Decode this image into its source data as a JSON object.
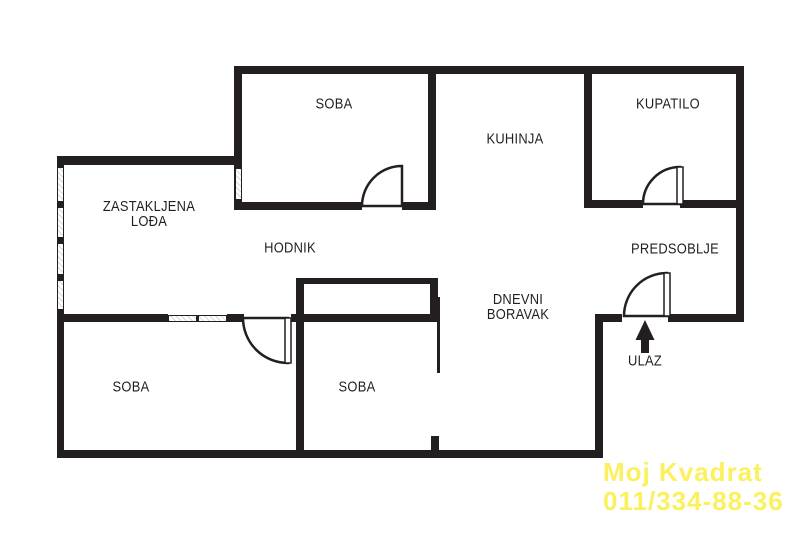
{
  "plan_title": "apartment-floor-plan",
  "colors": {
    "wall": "#231f20",
    "background": "#ffffff",
    "label_text": "#231f20",
    "watermark_yellow": "#fbf15d"
  },
  "rooms": {
    "soba_top": {
      "label": "SOBA"
    },
    "kuhinja": {
      "label": "KUHINJA"
    },
    "kupatilo": {
      "label": "KUPATILO"
    },
    "zastakljena_lodja": {
      "line1": "ZASTAKLJENA",
      "line2": "LOĐA"
    },
    "hodnik": {
      "label": "HODNIK"
    },
    "predsoblje": {
      "label": "PREDSOBLJE"
    },
    "dnevni_boravak": {
      "line1": "DNEVNI",
      "line2": "BORAVAK"
    },
    "soba_bottom_left": {
      "label": "SOBA"
    },
    "soba_bottom_middle": {
      "label": "SOBA"
    },
    "ulaz": {
      "label": "ULAZ"
    }
  },
  "watermark": {
    "line1": "Moj Kvadrat",
    "line2": "011/334-88-36"
  }
}
